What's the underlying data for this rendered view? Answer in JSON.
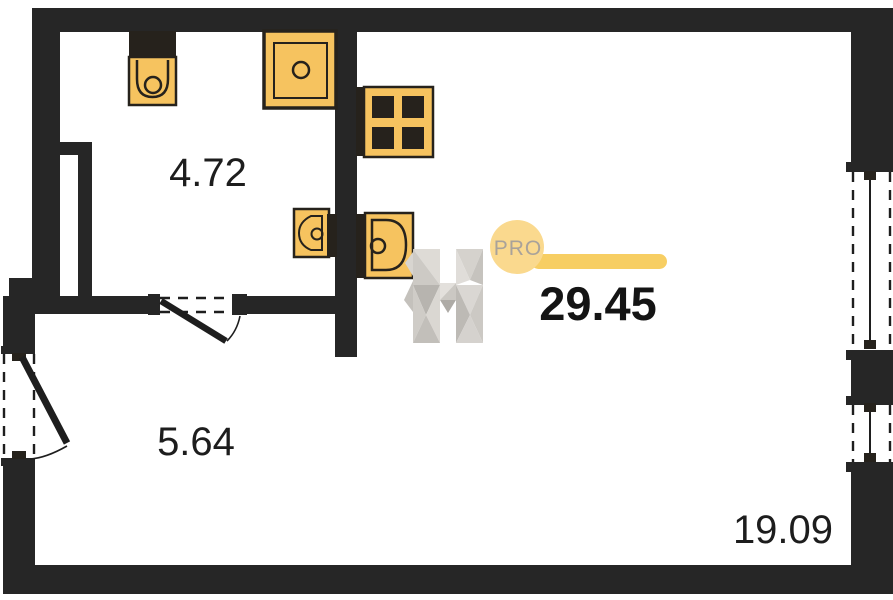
{
  "plan": {
    "type": "apartment-floor-plan",
    "rooms": [
      {
        "name": "bathroom-kitchen-block",
        "area": "4.72"
      },
      {
        "name": "hallway",
        "area": "5.64"
      },
      {
        "name": "living-room",
        "area": "19.09"
      }
    ],
    "total_area": "29.45"
  },
  "logo": {
    "letter": "H",
    "badge": "PRO"
  },
  "icons": [
    "toilet-icon",
    "shower-icon",
    "stove-icon",
    "bathroom-sink-icon",
    "kitchen-sink-icon",
    "entrance-door-icon",
    "interior-door-icon",
    "window-icon"
  ],
  "colors": {
    "wall_color": "#262626",
    "fixture_fill": "#F6C35F",
    "fixture_stroke": "#26221C",
    "badge_fill": "#FAD98E",
    "badge_text": "#A9A29A",
    "accent_bar": "#F7CE63",
    "label_text": "#1D1D1D",
    "background": "#FFFFFF"
  }
}
